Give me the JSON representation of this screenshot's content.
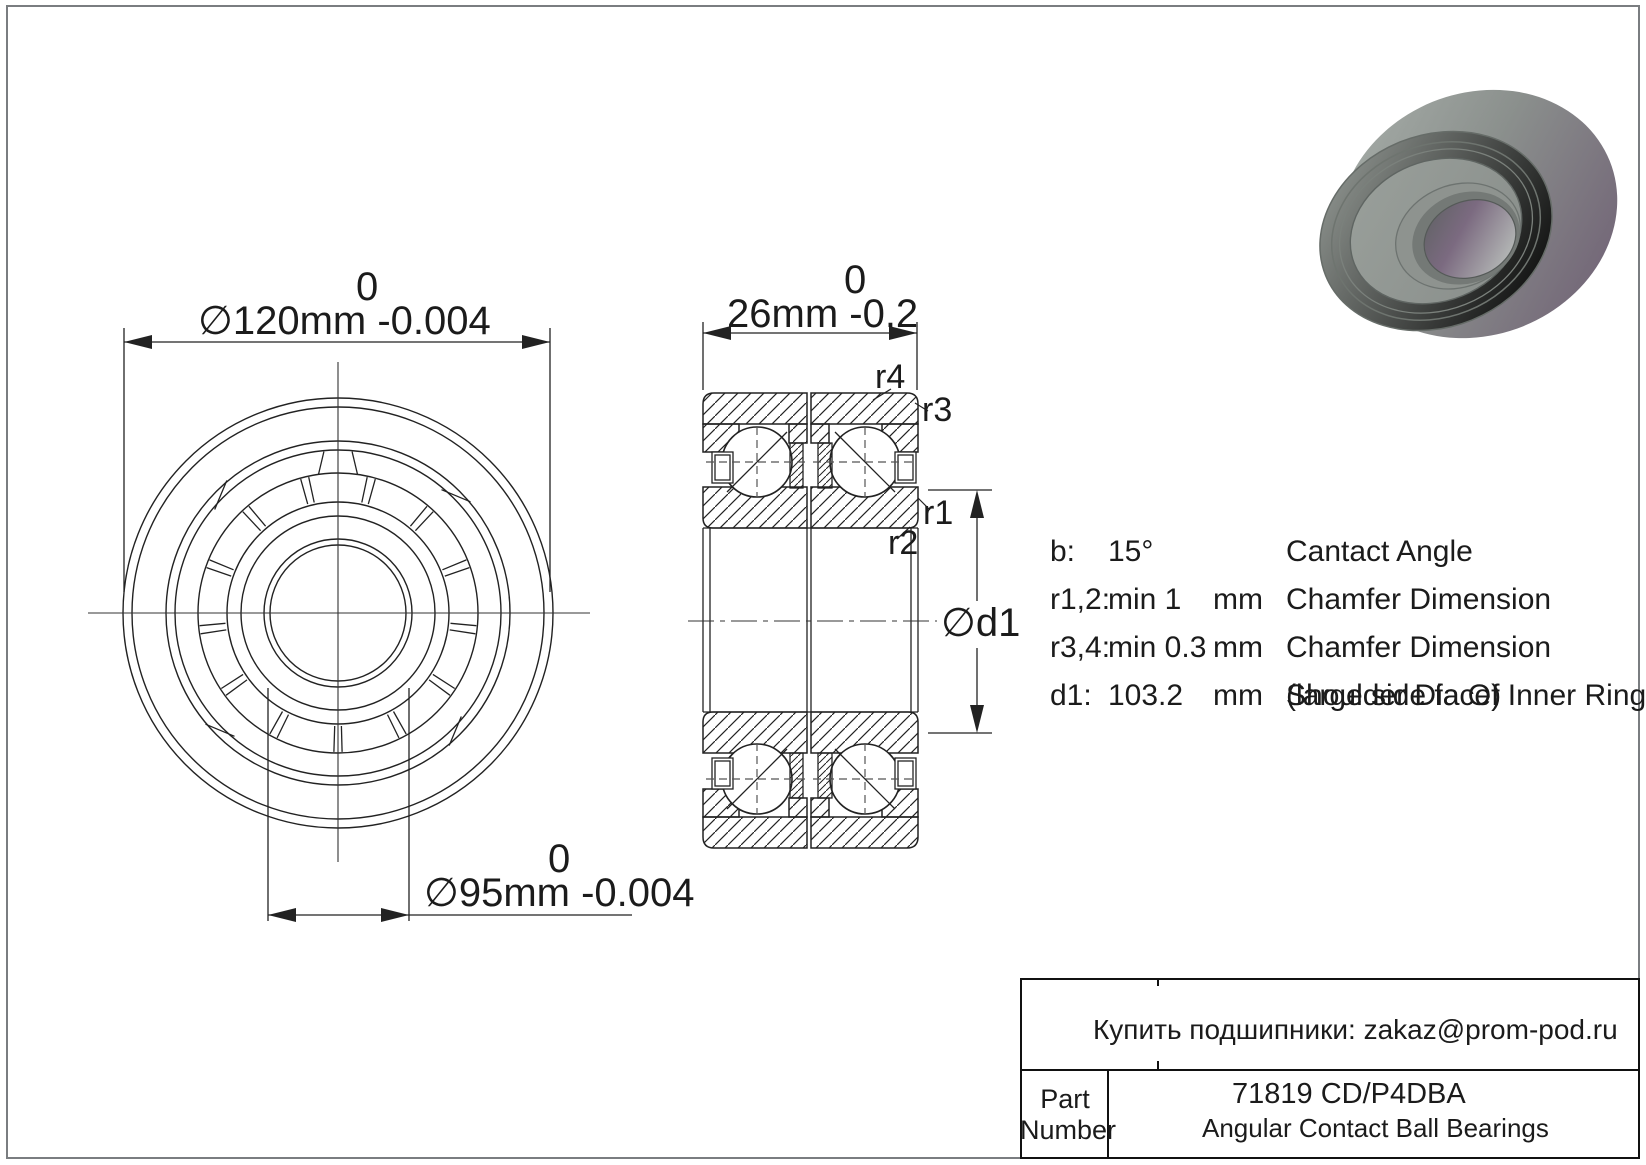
{
  "drawing": {
    "front_view": {
      "od_dim": {
        "tolerance_top": "0",
        "text": "∅120mm -0.004"
      },
      "bore_dim": {
        "tolerance_top": "0",
        "text": "∅95mm -0.004"
      }
    },
    "section_view": {
      "width_dim": {
        "tolerance_top": "0",
        "text": "26mm -0.2"
      },
      "chamfer_labels": {
        "r4": "r4",
        "r3": "r3",
        "r1": "r1",
        "r2": "r2"
      },
      "shoulder_dim_label": "∅d1"
    }
  },
  "specs": {
    "rows": [
      {
        "param": "b:",
        "value": "15°",
        "unit": "",
        "desc": "Cantact Angle",
        "desc2": ""
      },
      {
        "param": "r1,2:",
        "value": "min 1",
        "unit": "mm",
        "desc": "Chamfer Dimension",
        "desc2": ""
      },
      {
        "param": "r3,4:",
        "value": "min 0.3",
        "unit": "mm",
        "desc": "Chamfer Dimension",
        "desc2": ""
      },
      {
        "param": "d1:",
        "value": "103.2",
        "unit": "mm",
        "desc": "Shoulder Dia Of Inner Ring",
        "desc2": "(large side face)"
      }
    ]
  },
  "title_block": {
    "contact_line": "Купить подшипники: zakaz@prom-pod.ru",
    "part_label_line1": "Part",
    "part_label_line2": "Number",
    "part_number": "71819 CD/P4DBA",
    "category": "Angular Contact Ball Bearings"
  },
  "colors": {
    "line": "#1f1f1f",
    "centerline": "#333333",
    "frame_border": "#7a7d80",
    "metal_gray": "#8b908d",
    "metal_purple": "#6d5c72",
    "metal_light": "#a9b0ab"
  }
}
